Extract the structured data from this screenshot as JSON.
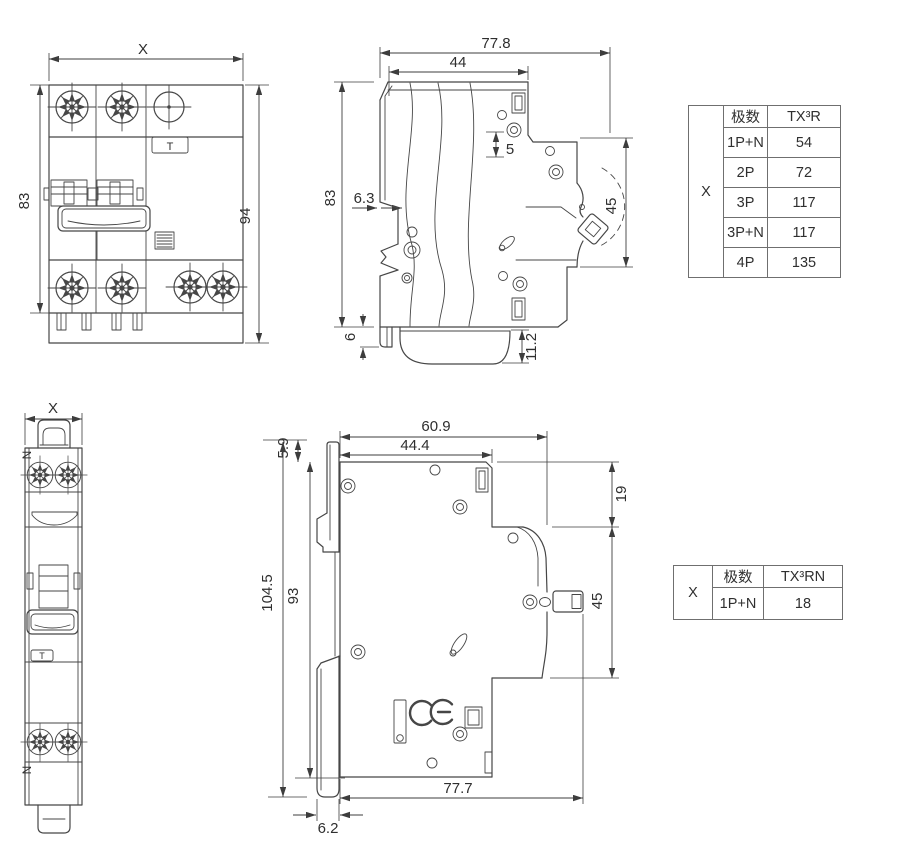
{
  "colors": {
    "line": "#464646",
    "dimension": "#3d3d3d",
    "text": "#2f2f2f",
    "table_border": "#6f6f6f",
    "background": "#ffffff"
  },
  "drawing": {
    "top_front": {
      "dims": {
        "width": "X",
        "height_left": "83",
        "height_right": "94"
      },
      "labels": {
        "test_button": "T"
      }
    },
    "top_side": {
      "dims": {
        "depth_total": "77.8",
        "depth_upper": "44",
        "gap": "5",
        "height": "83",
        "rail_offset": "6.3",
        "handle_zone": "45",
        "clip_tail": "6",
        "base_height": "11.2"
      }
    },
    "bottom_front": {
      "dims": {
        "width": "X"
      },
      "labels": {
        "neutral_top": "N",
        "neutral_bottom": "N",
        "test_button": "T"
      }
    },
    "bottom_side": {
      "dims": {
        "clip_top": "5.9",
        "depth_upper_total": "60.9",
        "depth_upper": "44.4",
        "top_step": "19",
        "height_total": "104.5",
        "height_body": "93",
        "handle_zone": "45",
        "depth_total": "77.7",
        "plate_thickness": "6.2"
      },
      "labels": {
        "ce_mark": "CE"
      }
    }
  },
  "tables": {
    "top": {
      "corner_label": "X",
      "columns": [
        "极数",
        "TX³R"
      ],
      "rows": [
        [
          "1P+N",
          "54"
        ],
        [
          "2P",
          "72"
        ],
        [
          "3P",
          "117"
        ],
        [
          "3P+N",
          "117"
        ],
        [
          "4P",
          "135"
        ]
      ]
    },
    "bottom": {
      "corner_label": "X",
      "columns": [
        "极数",
        "TX³RN"
      ],
      "rows": [
        [
          "1P+N",
          "18"
        ]
      ]
    }
  }
}
